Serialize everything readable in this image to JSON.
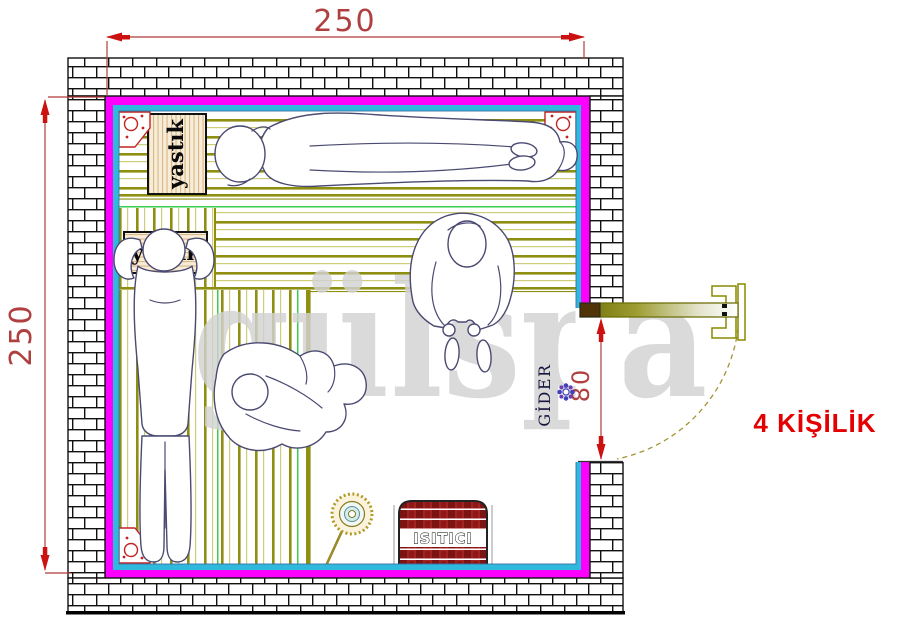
{
  "drawing": {
    "watermark": "gülspa",
    "capacity_label": "4 KİŞİLİK",
    "dims": {
      "top": "250",
      "left": "250",
      "door": "80"
    },
    "labels": {
      "pillow_top": "yastık",
      "pillow_left": "yastık",
      "drain": "GİDER",
      "heater": "ISITICI"
    },
    "colors": {
      "magenta": "#ff00ff",
      "cyan": "#2fb9dc",
      "dim_red": "#b04040",
      "arrow_red": "#cc1111",
      "capacity_red": "#e40000",
      "watermark_gray": "#d2d2d2",
      "slat_olive": "#8e8e10",
      "accent_green": "#39cc50",
      "heater_red": "#9b1c1c"
    }
  }
}
